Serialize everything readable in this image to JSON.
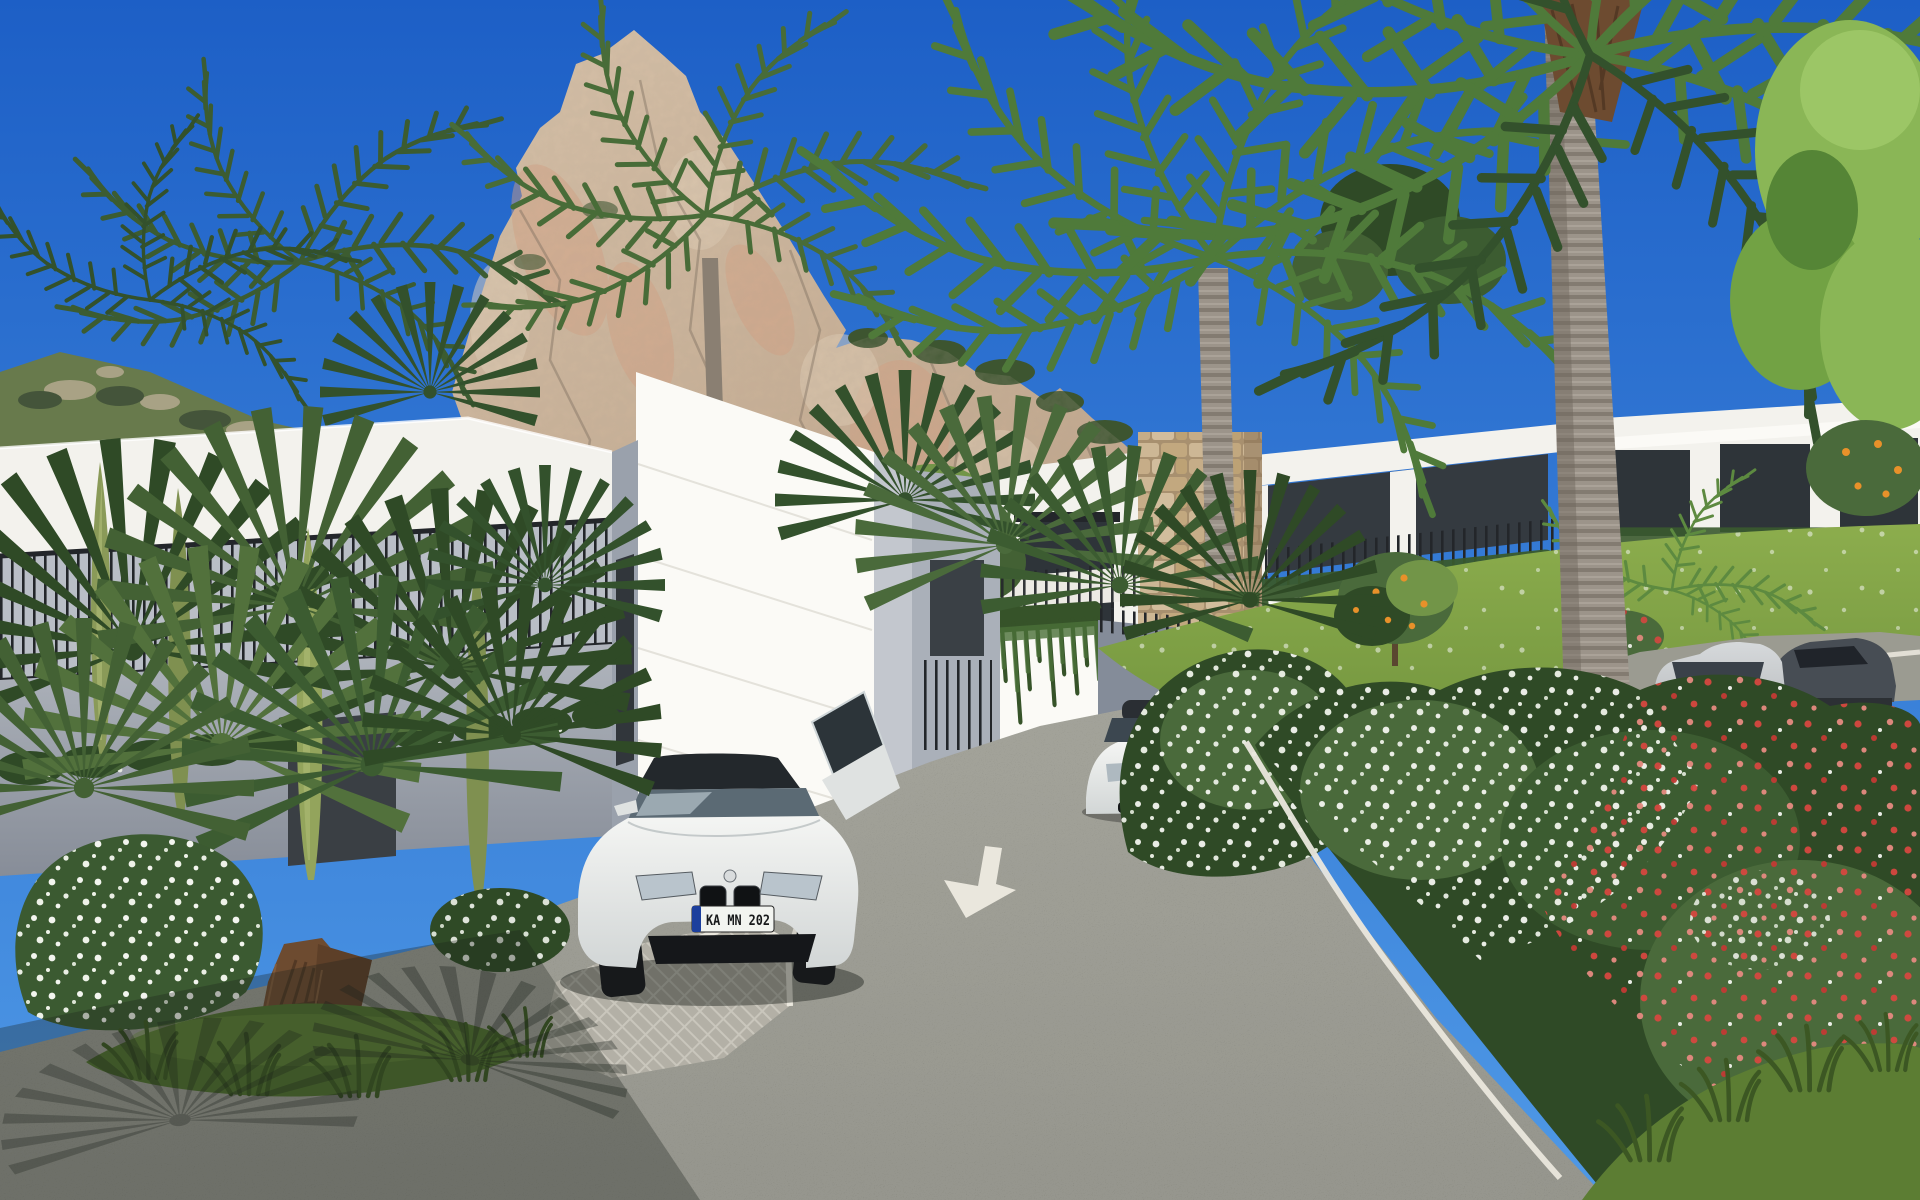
{
  "scene": {
    "description": "Sunny 3D architectural rendering: modern white villas beneath a limestone crag, palm trees, oleander flowers and cars on a curving residential road",
    "road_arrow_direction": "down",
    "vehicles": {
      "front_car": "white BMW coupe with open driver door",
      "front_car_plate": "KA MN 202",
      "middle_car": "white BMW behind flowering bush",
      "upper_car": "silver Audi estate",
      "upper_car_2": "dark grey coupe"
    }
  },
  "colors": {
    "sky_top": "#1d5fc6",
    "sky_horizon": "#4f99e6",
    "rock_light": "#dcc6ad",
    "rock_mid": "#bfa388",
    "rock_shadow": "#96816b",
    "rock_pink": "#d9a081",
    "scrub_green": "#3d5530",
    "hill_green": "#687a4c",
    "wall_white": "#f3f2ed",
    "wall_bright": "#fbfaf6",
    "wall_shade": "#c3c7ce",
    "wall_gray": "#9aa1ac",
    "glass_dark": "#2e3439",
    "railing_dark": "#23262a",
    "stone_tan": "#c8b393",
    "road_asphalt": "#8e8e84",
    "road_marking": "#eae7dd",
    "paver_gray": "#b7b4aa",
    "lawn_green": "#8cad4d",
    "leaf_dark": "#2f4a26",
    "leaf_mid": "#4a6a3b",
    "leaf_light": "#729548",
    "leaf_bright": "#8ab656",
    "trunk_gray": "#9c948a",
    "trunk_brown": "#6d4b30",
    "flower_white": "#f3f5ef",
    "flower_red": "#d5473f",
    "orange_fruit": "#e8912a",
    "car_white": "#eef0ee",
    "car_silver": "#c4c7ca",
    "taillight_red": "#b3231f",
    "plate_bg": "#f2f4f0",
    "plate_text": "#17191b",
    "plate_eu_blue": "#1c3f9d"
  }
}
